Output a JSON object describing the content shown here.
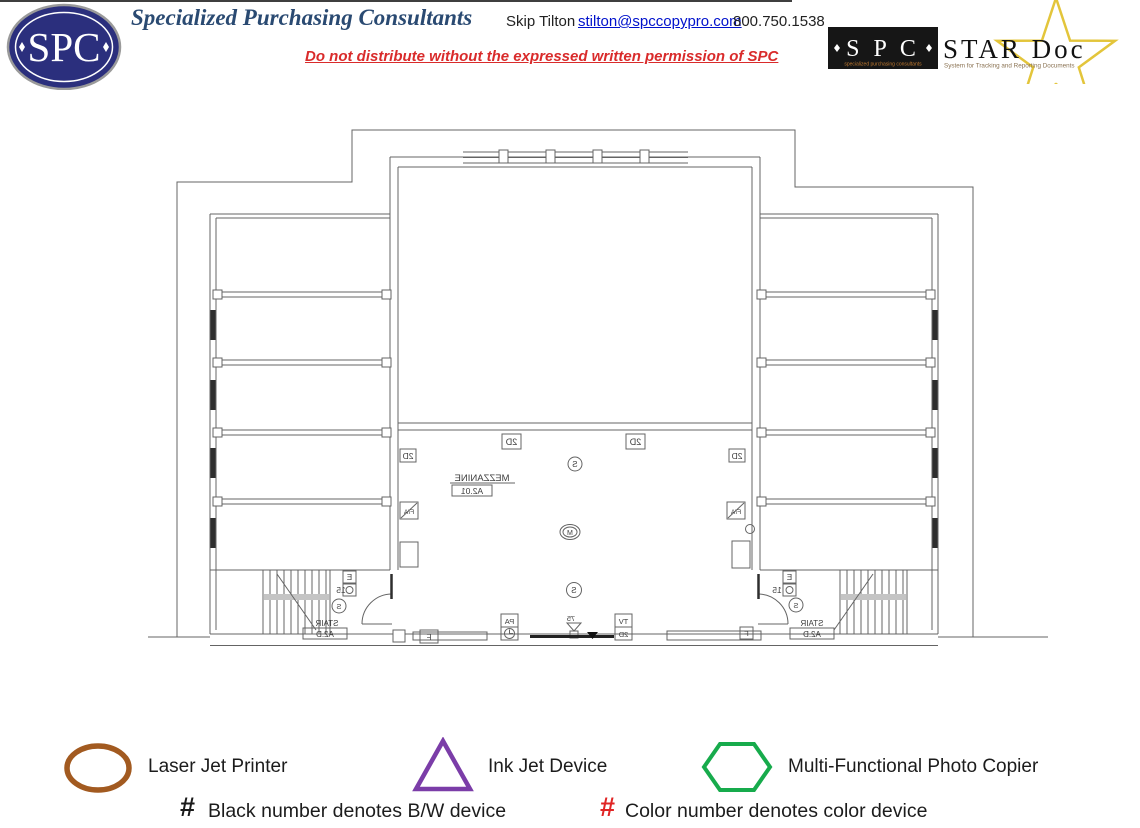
{
  "header": {
    "logo_text": "SPC",
    "company": "Specialized Purchasing Consultants",
    "contact_name": "Skip Tilton",
    "email": "stilton@spccopypro.com",
    "phone": "800.750.1538",
    "disclaimer": "Do not distribute without the expressed written permission of SPC",
    "stardoc": {
      "spc": "S P C",
      "spc_subtitle": "specialized purchasing consultants",
      "product": "STAR Doc",
      "tagline": "System for Tracking and Reporting Documents"
    }
  },
  "plan": {
    "labels": {
      "mezzanine": "MEZZANINE",
      "sheet": "A2.01",
      "stair": "STAIR",
      "stair_sheet": "A2.D",
      "d2": "2D",
      "s": "S",
      "m": "M",
      "fa": "F/A",
      "tv": "TV",
      "pa": "PA",
      "e": "E",
      "f": "F",
      "n15": "15",
      "n75": "75"
    }
  },
  "legend": {
    "items": [
      {
        "symbol": "oval",
        "color": "#A25A20",
        "label": "Laser Jet Printer"
      },
      {
        "symbol": "triangle",
        "color": "#7B3DA8",
        "label": "Ink Jet Device"
      },
      {
        "symbol": "hexagon",
        "color": "#17AB4C",
        "label": "Multi-Functional Photo Copier"
      }
    ],
    "notes": [
      {
        "symbol": "#",
        "color": "#1A1A1A",
        "label": "Black number denotes B/W device"
      },
      {
        "symbol": "#",
        "color": "#E02525",
        "label": "Color number denotes color device"
      }
    ]
  },
  "colors": {
    "logo_navy": "#2B2F7D",
    "title_blue": "#2A4A72",
    "link_blue": "#0011CC",
    "warning_red": "#D92B2B",
    "star_gold": "#E3C53B",
    "drawing_gray": "#646464"
  }
}
